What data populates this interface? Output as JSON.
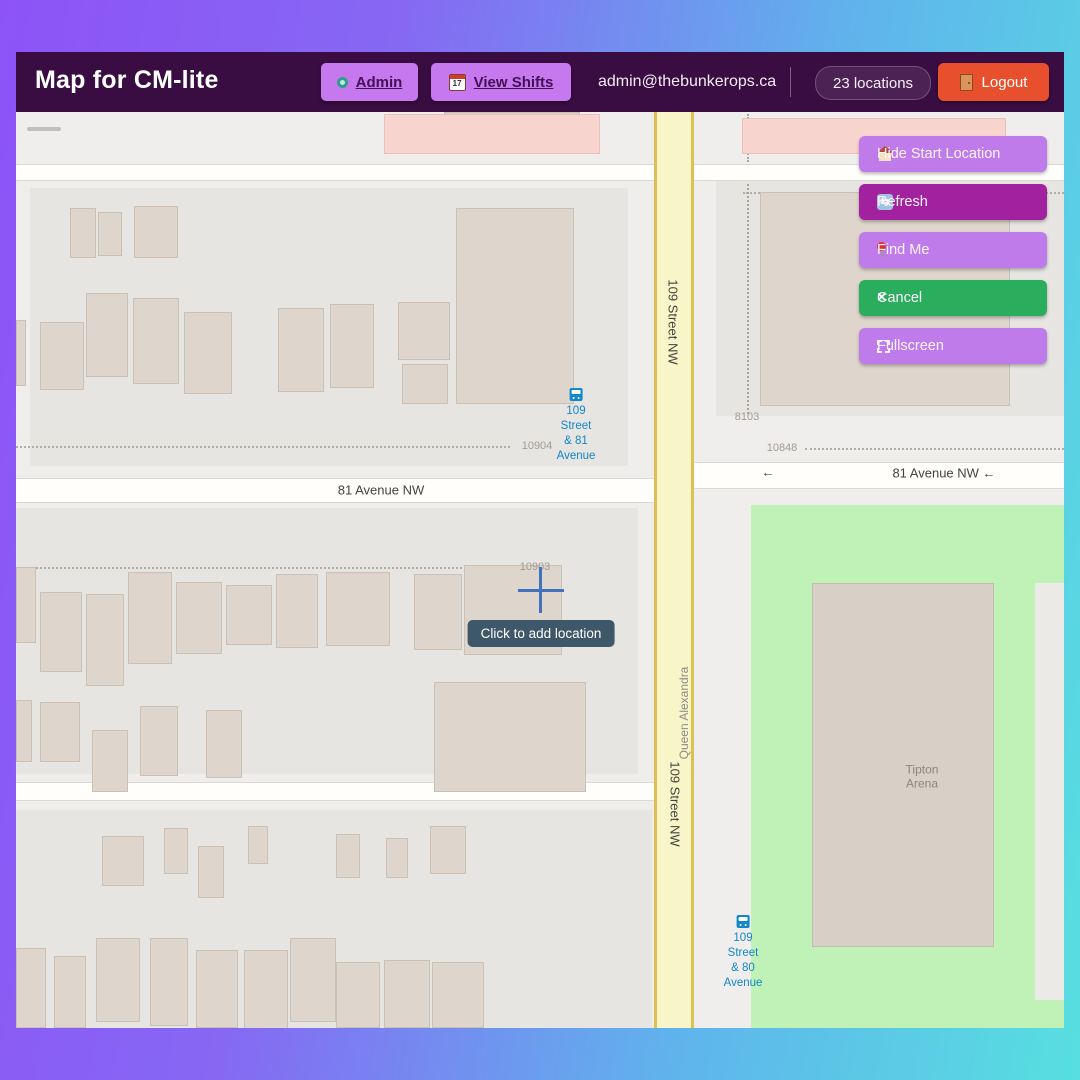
{
  "header": {
    "title": "Map for CM-lite",
    "admin_label": "Admin",
    "view_shifts_label": "View Shifts",
    "email": "admin@thebunkerops.ca",
    "locations_badge": "23 locations",
    "logout_label": "Logout"
  },
  "map_controls": {
    "zoom_in": "+",
    "zoom_out": "−",
    "buttons": [
      {
        "label": "Hide Start Location",
        "color": "#bf7be9",
        "icon": "home-icon"
      },
      {
        "label": "Refresh",
        "color": "#a2219f",
        "icon": "refresh-icon"
      },
      {
        "label": "Find Me",
        "color": "#bf7be9",
        "icon": "pin-icon"
      },
      {
        "label": "Cancel",
        "color": "#2aad5d",
        "icon": "x-icon"
      },
      {
        "label": "Fullscreen",
        "color": "#bf7be9",
        "icon": "fullscreen-icon"
      }
    ]
  },
  "map": {
    "tooltip": {
      "text": "Click to add location",
      "x": 525,
      "y": 522
    },
    "crosshair": {
      "x": 525,
      "y": 478
    },
    "street_labels": [
      {
        "text": "81 Avenue NW",
        "x": 365,
        "y": 378,
        "rot": 0
      },
      {
        "text": "←",
        "x": 752,
        "y": 360,
        "rot": 0
      },
      {
        "text": "81 Avenue NW ←",
        "x": 928,
        "y": 361,
        "rot": 0
      },
      {
        "text": "109 Street NW",
        "x": 657,
        "y": 210,
        "rot": 90
      },
      {
        "text": "109 Street NW",
        "x": 659,
        "y": 692,
        "rot": 90
      },
      {
        "text": "Queen Alexandra",
        "x": 668,
        "y": 601,
        "rot": -90,
        "muted": true
      }
    ],
    "house_numbers": [
      {
        "text": "10904",
        "x": 521,
        "y": 334
      },
      {
        "text": "10903",
        "x": 519,
        "y": 455
      },
      {
        "text": "10848",
        "x": 766,
        "y": 336
      },
      {
        "text": "8103",
        "x": 731,
        "y": 305
      }
    ],
    "bus_stops": [
      {
        "line1": "109 Street",
        "line2": "& 81 Avenue",
        "x": 560,
        "y": 276
      },
      {
        "line1": "109 Street",
        "line2": "& 80 Avenue",
        "x": 727,
        "y": 803
      }
    ],
    "poi": {
      "line1": "Tipton",
      "line2": "Arena",
      "x": 906,
      "y": 665
    },
    "shapes": {
      "landuse": [
        [
          14,
          76,
          598,
          278
        ],
        [
          0,
          396,
          622,
          266
        ],
        [
          0,
          698,
          636,
          218
        ],
        [
          700,
          62,
          348,
          242
        ]
      ],
      "park": [
        735,
        393,
        313,
        523
      ],
      "park_path": [
        1019,
        471,
        29,
        417
      ],
      "roads_h": [
        [
          0,
          52,
          1048,
          17
        ],
        [
          0,
          366,
          658,
          25
        ],
        [
          658,
          350,
          390,
          27
        ],
        [
          0,
          670,
          658,
          19
        ]
      ],
      "road_v": [
        638,
        0,
        40,
        916
      ],
      "buildings": [
        [
          54,
          96,
          26,
          50
        ],
        [
          82,
          100,
          24,
          44
        ],
        [
          118,
          94,
          44,
          52
        ],
        [
          440,
          96,
          118,
          196
        ],
        [
          0,
          208,
          10,
          66
        ],
        [
          24,
          210,
          44,
          68
        ],
        [
          70,
          181,
          42,
          84
        ],
        [
          117,
          186,
          46,
          86
        ],
        [
          168,
          200,
          48,
          82
        ],
        [
          262,
          196,
          46,
          84
        ],
        [
          314,
          192,
          44,
          84
        ],
        [
          382,
          190,
          52,
          58
        ],
        [
          386,
          252,
          46,
          40
        ],
        [
          744,
          80,
          250,
          214
        ],
        [
          0,
          455,
          20,
          76
        ],
        [
          24,
          480,
          42,
          80
        ],
        [
          70,
          482,
          38,
          92
        ],
        [
          112,
          460,
          44,
          92
        ],
        [
          160,
          470,
          46,
          72
        ],
        [
          210,
          473,
          46,
          60
        ],
        [
          260,
          462,
          42,
          74
        ],
        [
          310,
          460,
          64,
          74
        ],
        [
          398,
          462,
          48,
          76
        ],
        [
          448,
          453,
          98,
          90
        ],
        [
          0,
          588,
          16,
          62
        ],
        [
          24,
          590,
          40,
          60
        ],
        [
          76,
          618,
          36,
          62
        ],
        [
          124,
          594,
          38,
          70
        ],
        [
          190,
          598,
          36,
          68
        ],
        [
          418,
          570,
          152,
          110
        ],
        [
          86,
          724,
          42,
          50
        ],
        [
          148,
          716,
          24,
          46
        ],
        [
          182,
          734,
          26,
          52
        ],
        [
          232,
          714,
          20,
          38
        ],
        [
          320,
          722,
          24,
          44
        ],
        [
          370,
          726,
          22,
          40
        ],
        [
          414,
          714,
          36,
          48
        ],
        [
          0,
          836,
          30,
          80
        ],
        [
          38,
          844,
          32,
          72
        ],
        [
          80,
          826,
          44,
          84
        ],
        [
          134,
          826,
          38,
          88
        ],
        [
          180,
          838,
          42,
          78
        ],
        [
          228,
          838,
          44,
          80
        ],
        [
          274,
          826,
          46,
          84
        ],
        [
          320,
          850,
          44,
          66
        ],
        [
          368,
          848,
          46,
          68
        ],
        [
          416,
          850,
          52,
          66
        ]
      ],
      "pink_buildings": [
        [
          368,
          2,
          216,
          40
        ],
        [
          726,
          6,
          264,
          36
        ]
      ],
      "top_buildings": [
        [
          428,
          0,
          136,
          22
        ]
      ],
      "arena": [
        796,
        471,
        182,
        364
      ],
      "dotted_h": [
        [
          0,
          334,
          494
        ],
        [
          0,
          455,
          490
        ],
        [
          789,
          336,
          259
        ],
        [
          727,
          80,
          321
        ]
      ],
      "dotted_v": [
        [
          731,
          2,
          48
        ],
        [
          731,
          72,
          230
        ]
      ]
    },
    "colors": {
      "header_bg": "#3a0d42",
      "accent_purple": "#bf7be9",
      "magenta": "#a2219f",
      "green": "#2aad5d",
      "logout_red": "#e8502d",
      "park_green": "#c0f2b8",
      "road_yellow": "#f8f5c8",
      "transit_blue": "#1287c9"
    }
  }
}
